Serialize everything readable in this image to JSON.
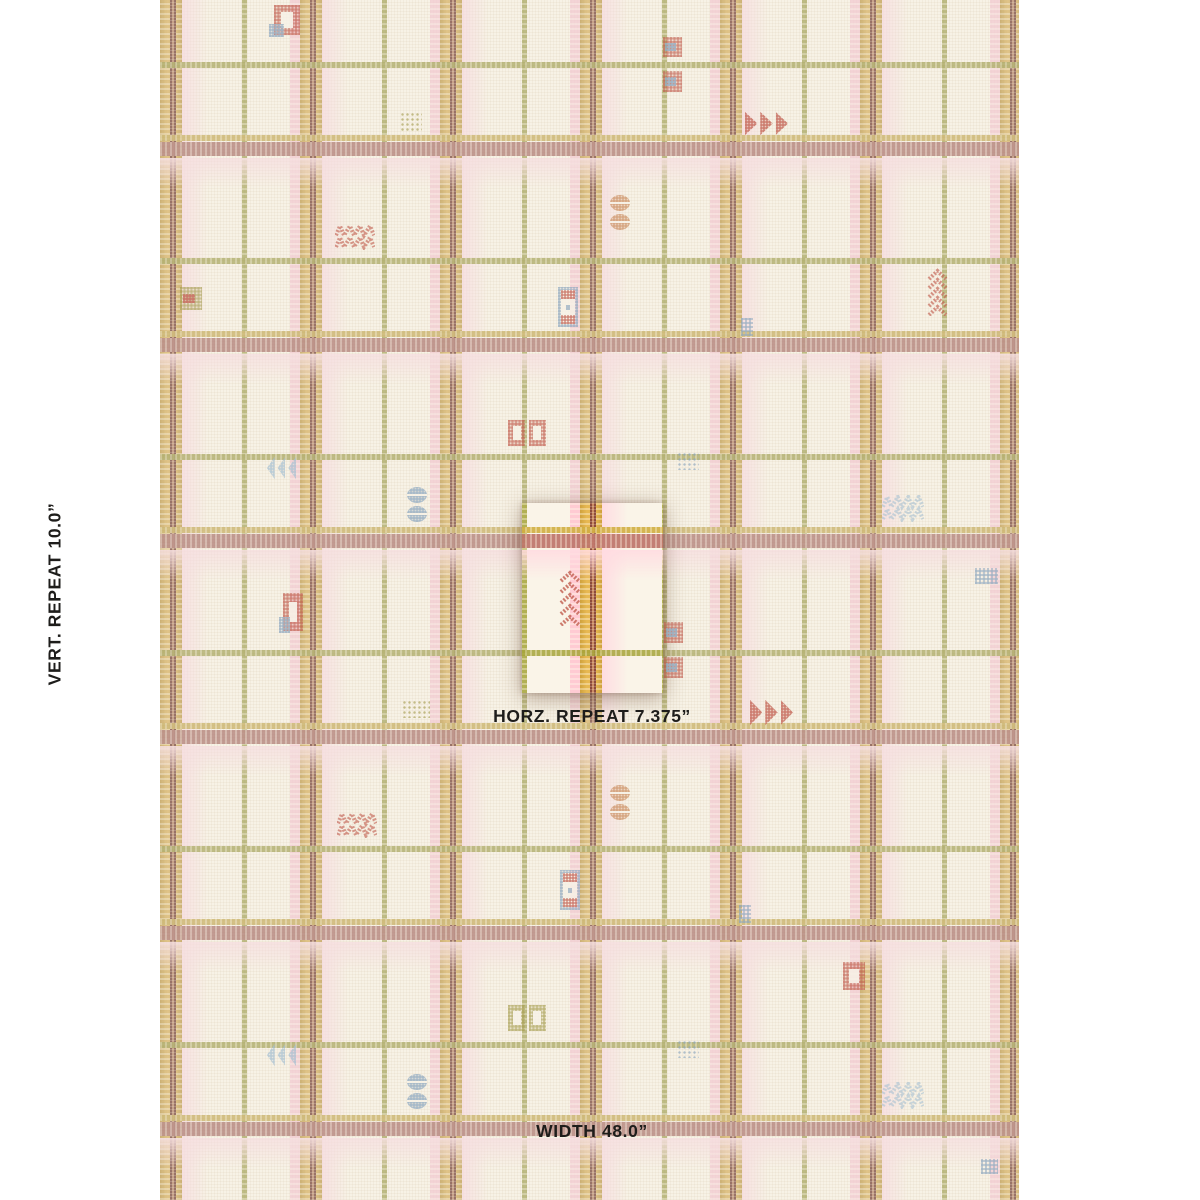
{
  "page": {
    "background": "#ffffff"
  },
  "labels": {
    "vertical": {
      "label": "VERT. REPEAT",
      "value": "10.0”"
    },
    "horizontal": {
      "label": "HORZ. REPEAT",
      "value": "7.375”"
    },
    "width": {
      "label": "WIDTH",
      "value": "48.0”"
    }
  },
  "label_positions": {
    "vertical": {
      "cx": 55,
      "cy": 594
    },
    "horizontal": {
      "cx": 592,
      "top": 706
    },
    "width": {
      "cx": 592,
      "top": 1121
    }
  },
  "fabric": {
    "x": 160,
    "y": 0,
    "width": 859,
    "height": 1200,
    "base": "#f7f2e6"
  },
  "highlight": {
    "x": 522,
    "y": 503,
    "width": 141,
    "height": 190
  },
  "palette": {
    "weave": "rgba(213,198,172,0.16)",
    "gold": "#d9b76e",
    "gold_edge": "#c2a159",
    "gold_line": "#c6ad5f",
    "brown": "#7f5044",
    "brown_light": "#bb8e72",
    "olive": "#a3a155",
    "mauve": "#ae7a72",
    "pink_band": "#f3ccd2",
    "pink_wash": "#f6dbdf",
    "cream": "#f7f2e7",
    "motif": {
      "red": "#c05a4b",
      "blue": "#8ba6bf",
      "lightblue": "#a7c0d2",
      "olive": "#a79e52",
      "tan": "#cc9063"
    }
  },
  "plaid": {
    "vertical_clusters": [
      172,
      312,
      452,
      592,
      732,
      872,
      1012
    ],
    "vertical_olive": [
      242,
      382,
      522,
      662,
      802,
      942
    ],
    "horizontal_mauve": [
      152,
      348,
      544,
      740,
      936,
      1132
    ],
    "horizontal_olive": [
      62,
      258,
      454,
      650,
      846,
      1042
    ]
  },
  "motifs": [
    {
      "type": "frame",
      "x": 274,
      "y": 5,
      "w": 26,
      "h": 30,
      "color": "red",
      "corner": "blue"
    },
    {
      "type": "gingham",
      "x": 663,
      "y": 37,
      "w": 19,
      "h": 20,
      "color": "red",
      "accent": "blue"
    },
    {
      "type": "gingham",
      "x": 663,
      "y": 71,
      "w": 19,
      "h": 21,
      "color": "red",
      "accent": "blue"
    },
    {
      "type": "dotgrid",
      "x": 400,
      "y": 112,
      "w": 22,
      "h": 20,
      "color": "olive"
    },
    {
      "type": "arrows-right",
      "x": 745,
      "y": 112,
      "w": 46,
      "h": 23,
      "color": "red"
    },
    {
      "type": "circles",
      "x": 610,
      "y": 195,
      "w": 20,
      "h": 35,
      "color": "tan"
    },
    {
      "type": "zigzag",
      "x": 335,
      "y": 224,
      "w": 40,
      "h": 26,
      "color": "red"
    },
    {
      "type": "tree",
      "x": 927,
      "y": 268,
      "w": 21,
      "h": 48,
      "color": "red"
    },
    {
      "type": "gingham",
      "x": 180,
      "y": 287,
      "w": 22,
      "h": 23,
      "color": "olive",
      "accent": "red"
    },
    {
      "type": "window",
      "x": 558,
      "y": 287,
      "w": 20,
      "h": 40,
      "color": "blue",
      "accent": "red"
    },
    {
      "type": "dotchecker",
      "x": 741,
      "y": 318,
      "w": 12,
      "h": 18,
      "color": "blue"
    },
    {
      "type": "twosquares",
      "x": 508,
      "y": 420,
      "w": 38,
      "h": 26,
      "color": "red"
    },
    {
      "type": "arrows-left",
      "x": 267,
      "y": 457,
      "w": 32,
      "h": 22,
      "color": "lightblue"
    },
    {
      "type": "dotgrid",
      "x": 677,
      "y": 452,
      "w": 22,
      "h": 18,
      "color": "blue"
    },
    {
      "type": "circles",
      "x": 407,
      "y": 487,
      "w": 20,
      "h": 35,
      "color": "blue"
    },
    {
      "type": "zigzag",
      "x": 882,
      "y": 495,
      "w": 42,
      "h": 27,
      "color": "lightblue"
    },
    {
      "type": "tree",
      "x": 559,
      "y": 570,
      "w": 22,
      "h": 56,
      "color": "red"
    },
    {
      "type": "gingham",
      "x": 664,
      "y": 622,
      "w": 19,
      "h": 21,
      "color": "red",
      "accent": "blue"
    },
    {
      "type": "gingham",
      "x": 664,
      "y": 657,
      "w": 19,
      "h": 21,
      "color": "red",
      "accent": "blue"
    },
    {
      "type": "dotchecker",
      "x": 975,
      "y": 568,
      "w": 23,
      "h": 16,
      "color": "blue"
    },
    {
      "type": "frame",
      "x": 283,
      "y": 593,
      "w": 20,
      "h": 38,
      "color": "red",
      "corner": "blue"
    },
    {
      "type": "dotgrid",
      "x": 402,
      "y": 700,
      "w": 28,
      "h": 18,
      "color": "olive"
    },
    {
      "type": "arrows-right",
      "x": 750,
      "y": 700,
      "w": 46,
      "h": 25,
      "color": "red"
    },
    {
      "type": "circles",
      "x": 610,
      "y": 785,
      "w": 20,
      "h": 35,
      "color": "tan"
    },
    {
      "type": "zigzag",
      "x": 337,
      "y": 812,
      "w": 40,
      "h": 26,
      "color": "red"
    },
    {
      "type": "window",
      "x": 560,
      "y": 870,
      "w": 20,
      "h": 40,
      "color": "blue",
      "accent": "red"
    },
    {
      "type": "dotchecker",
      "x": 739,
      "y": 905,
      "w": 12,
      "h": 18,
      "color": "blue"
    },
    {
      "type": "frame",
      "x": 843,
      "y": 962,
      "w": 22,
      "h": 28,
      "color": "red"
    },
    {
      "type": "twosquares",
      "x": 508,
      "y": 1005,
      "w": 38,
      "h": 26,
      "color": "olive"
    },
    {
      "type": "arrows-left",
      "x": 267,
      "y": 1044,
      "w": 32,
      "h": 22,
      "color": "lightblue"
    },
    {
      "type": "dotgrid",
      "x": 677,
      "y": 1040,
      "w": 22,
      "h": 18,
      "color": "blue"
    },
    {
      "type": "circles",
      "x": 407,
      "y": 1074,
      "w": 20,
      "h": 35,
      "color": "blue"
    },
    {
      "type": "zigzag",
      "x": 882,
      "y": 1082,
      "w": 42,
      "h": 27,
      "color": "lightblue"
    },
    {
      "type": "dotchecker",
      "x": 981,
      "y": 1159,
      "w": 17,
      "h": 15,
      "color": "blue"
    }
  ]
}
